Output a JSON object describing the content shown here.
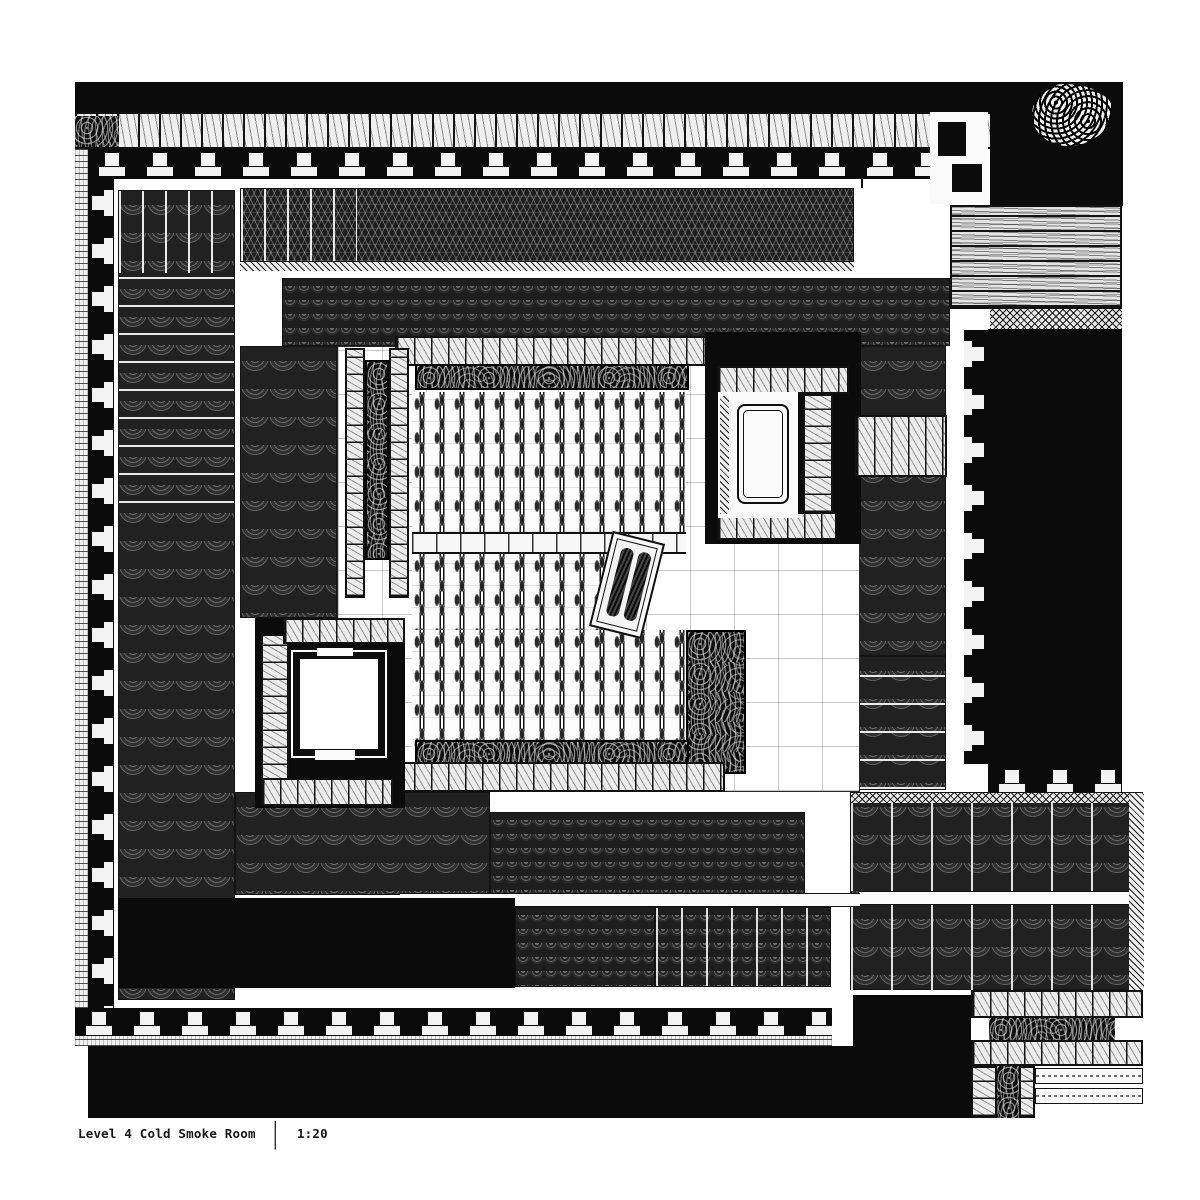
{
  "title_block": {
    "drawing_title": "Level 4 Cold Smoke Room",
    "separator": "|",
    "scale_label": "1:20"
  },
  "drawing": {
    "type": "architectural plan",
    "level": "4",
    "room_name": "Cold Smoke Room",
    "scale_ratio": "1:20"
  },
  "palette": {
    "paper": "#ffffff",
    "ink": "#111111",
    "hatch_dark": "#2e2e2e",
    "hatch_mid": "#555555",
    "block_fill": "#ececec"
  }
}
